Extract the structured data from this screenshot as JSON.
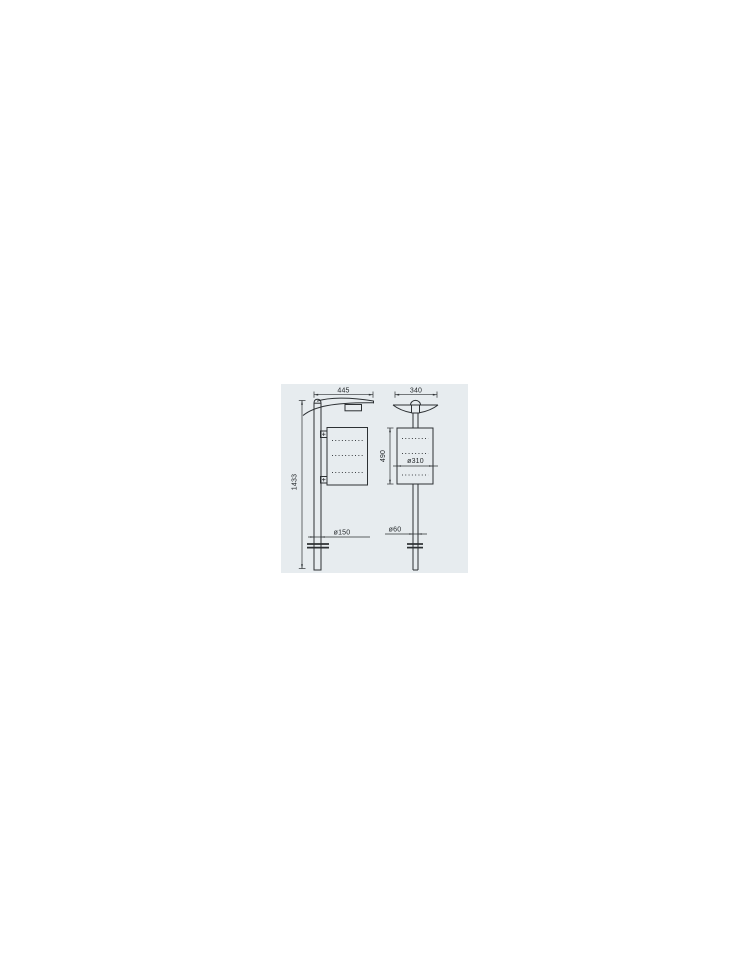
{
  "drawing": {
    "panel_bg": "#e7ecef",
    "line_color": "#2c3033",
    "side_view": {
      "arm_width": "445",
      "overall_height": "1433",
      "base_diameter": "ø150"
    },
    "front_view": {
      "canopy_width": "340",
      "bin_height": "490",
      "bin_diameter": "ø310",
      "post_diameter": "ø60"
    }
  }
}
